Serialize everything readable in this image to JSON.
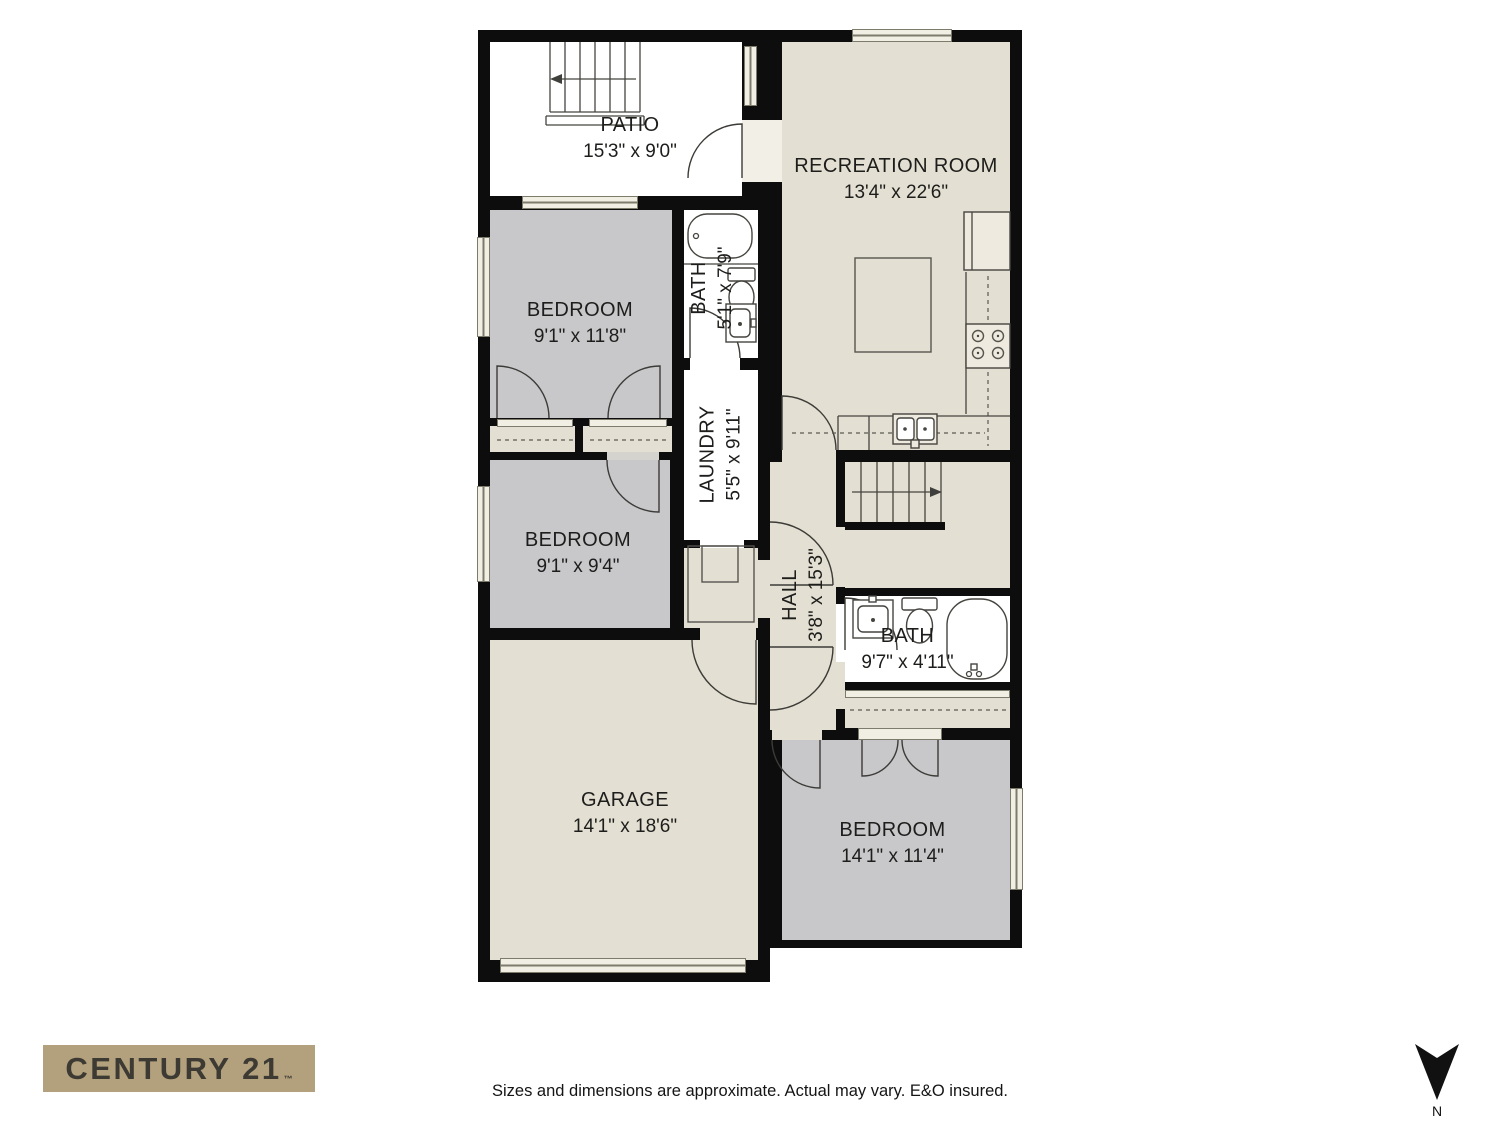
{
  "plan": {
    "rooms": [
      {
        "name": "PATIO",
        "dims": "15'3\" x 9'0\""
      },
      {
        "name": "RECREATION ROOM",
        "dims": "13'4\" x 22'6\""
      },
      {
        "name": "BEDROOM",
        "dims": "9'1\" x 11'8\""
      },
      {
        "name": "BATH",
        "dims": "5'1\" x 7'9\""
      },
      {
        "name": "LAUNDRY",
        "dims": "5'5\" x 9'11\""
      },
      {
        "name": "BEDROOM",
        "dims": "9'1\" x 9'4\""
      },
      {
        "name": "HALL",
        "dims": "3'8\" x 15'3\""
      },
      {
        "name": "BATH",
        "dims": "9'7\" x 4'11\""
      },
      {
        "name": "GARAGE",
        "dims": "14'1\" x 18'6\""
      },
      {
        "name": "BEDROOM",
        "dims": "14'1\" x 11'4\""
      }
    ],
    "compass_label": "N"
  },
  "footer": {
    "brand": "CENTURY 21",
    "brand_trademark": "™",
    "disclaimer": "Sizes and dimensions are approximate. Actual may vary. E&O insured."
  },
  "colors": {
    "wall": "#0d0d0d",
    "floor_light": "#e3dfd2",
    "floor_gray": "#c8c8cb",
    "floor_white": "#ffffff",
    "window_fill": "#f1eee3",
    "brand_bg": "#b3a17d",
    "brand_text": "#3d3933",
    "line": "#45443f"
  }
}
